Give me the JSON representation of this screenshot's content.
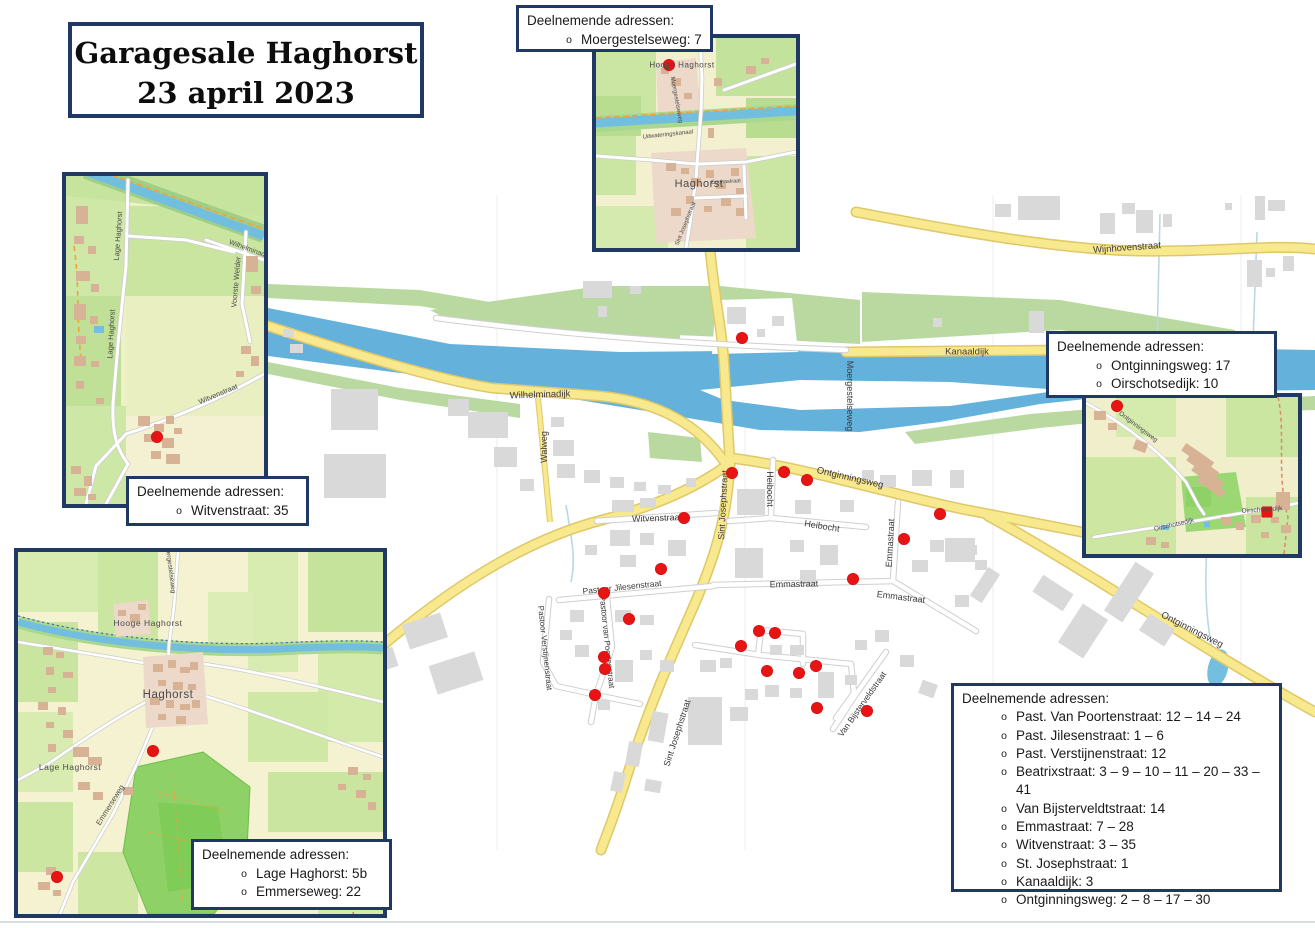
{
  "title": {
    "line1": "Garagesale Haghorst",
    "line2": "23 april 2023"
  },
  "callouts": {
    "heading": "Deelnemende adressen:",
    "bullet": "o",
    "top": {
      "items": [
        "Moergestelseweg: 7"
      ]
    },
    "left": {
      "items": [
        "Witvenstraat: 35"
      ]
    },
    "bottom_left": {
      "items": [
        "Lage Haghorst: 5b",
        "Emmerseweg: 22"
      ]
    },
    "right": {
      "items": [
        "Ontginningsweg: 17",
        "Oirschotsedijk: 10"
      ]
    },
    "main": {
      "items": [
        "Past. Van Poortenstraat: 12 – 14 – 24",
        "Past. Jilesenstraat: 1 – 6",
        "Past. Verstijnenstraat: 12",
        "Beatrixstraat: 3 – 9 – 10 – 11 – 20 – 33 – 41",
        "Van Bijsterveldtstraat: 14",
        "Emmastraat: 7 – 28",
        "Witvenstraat: 3 – 35",
        "St. Josephstraat: 1",
        "Kanaaldijk: 3",
        "Ontginningsweg: 2 – 8 – 17 – 30"
      ]
    }
  },
  "street_labels": {
    "wijnhovenstraat": "Wijnhovenstraat",
    "wilhelminadijk": "Wilhelminadijk",
    "kanaaldijk": "Kanaaldijk",
    "moergestelseweg": "Moergestelseweg",
    "walweg": "Walweg",
    "witvenstraat": "Witvenstraat",
    "sint_josephstraat": "Sint Josephstraat",
    "heibocht": "Heibocht",
    "ontginningsweg": "Ontginningsweg",
    "emmastraat": "Emmastraat",
    "pastoor_jilesenstraat": "Pastoor Jilesenstraat",
    "pastoor_verstijnenstraat": "Pastoor Verstijnenstraat",
    "pastoor_van_poortenstraat": "Pastoor van Poortenstraat",
    "van_bijsterveldstraat": "Van Bijsterveldstraat"
  },
  "inset_labels": {
    "top": {
      "hooge_haghorst": "Hooge Haghorst",
      "haghorst": "Haghorst",
      "moergestelseweg": "Moergestelseweg",
      "sint_josephstraat": "Sint Josephstraat",
      "emmastraat": "Emmastraat",
      "uitwateringskanaal": "Uitwateringskanaal"
    },
    "left": {
      "lage_haghorst": "Lage Haghorst",
      "voorste_welder": "Voorste Welder",
      "witvenstraat": "Witvenstraat",
      "wilhelminadijk": "Wilhelminadijk"
    },
    "bottom_left": {
      "hooge_haghorst": "Hooge Haghorst",
      "haghorst": "Haghorst",
      "lage_haghorst": "Lage Haghorst",
      "emmerseweg": "Emmerseweg",
      "moergestelseweg": "Moergestelseweg"
    },
    "right": {
      "ontginningsweg": "Ontginningsweg",
      "oirschotsedijk": "Oirschotsedijk"
    }
  },
  "markers": {
    "main": [
      [
        742,
        338
      ],
      [
        732,
        473
      ],
      [
        784,
        472
      ],
      [
        807,
        480
      ],
      [
        684,
        518
      ],
      [
        940,
        514
      ],
      [
        904,
        539
      ],
      [
        853,
        579
      ],
      [
        661,
        569
      ],
      [
        604,
        593
      ],
      [
        629,
        619
      ],
      [
        759,
        631
      ],
      [
        775,
        633
      ],
      [
        741,
        646
      ],
      [
        604,
        657
      ],
      [
        605,
        669
      ],
      [
        816,
        666
      ],
      [
        767,
        671
      ],
      [
        799,
        673
      ],
      [
        595,
        695
      ],
      [
        817,
        708
      ],
      [
        867,
        711
      ]
    ],
    "inset_top": [
      [
        73,
        27
      ]
    ],
    "inset_left": [
      [
        91,
        261
      ]
    ],
    "inset_bottom_left": [
      [
        135,
        199
      ],
      [
        39,
        325
      ]
    ],
    "inset_right": [
      [
        31,
        9
      ],
      [
        181,
        115,
        "sq"
      ]
    ]
  },
  "colors": {
    "border_navy": "#1f3864",
    "marker_red": "#e81414",
    "road_yellow": "#f8e88e",
    "water_blue": "#64b1dc"
  }
}
